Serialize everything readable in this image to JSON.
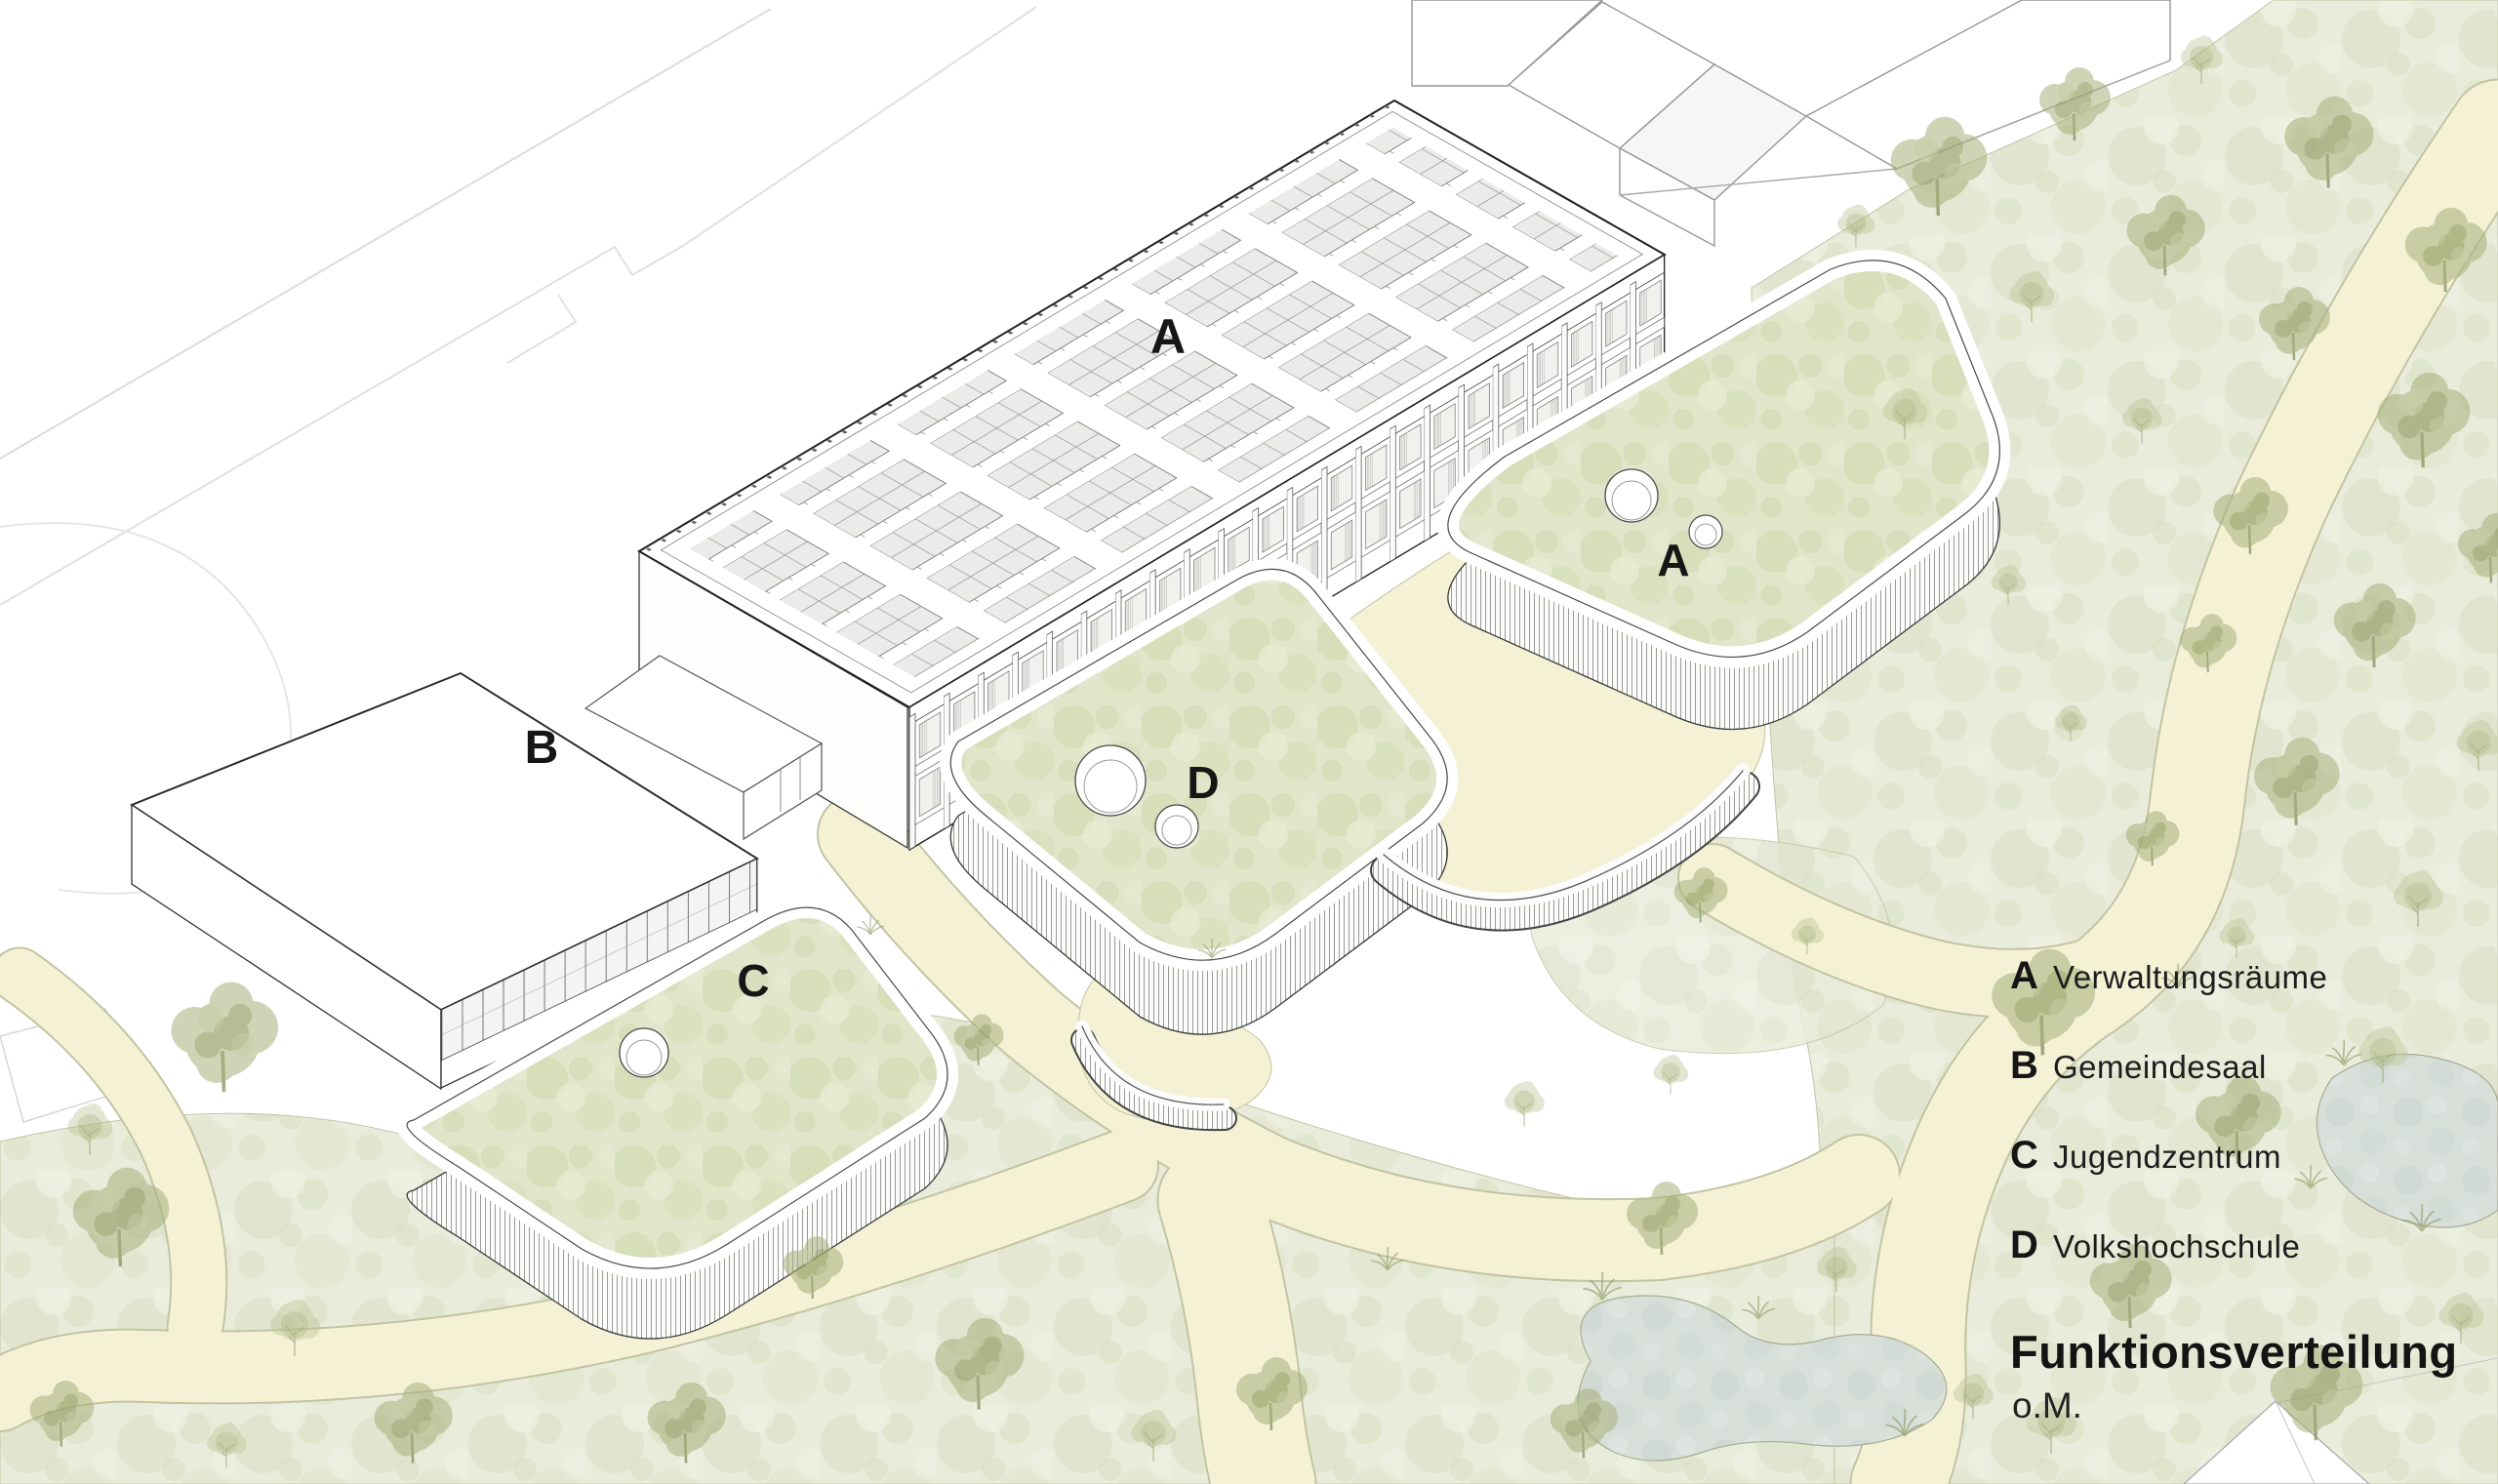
{
  "diagram": {
    "kind": "architectural axonometric site diagram",
    "building_labels": {
      "bar_roof": "A",
      "wing_a_roof": "A",
      "hall_b": "B",
      "wing_c_roof": "C",
      "wing_d_roof": "D"
    },
    "legend": {
      "items": [
        {
          "key": "A",
          "label": "Verwaltungsräume"
        },
        {
          "key": "B",
          "label": "Gemeindesaal"
        },
        {
          "key": "C",
          "label": "Jugendzentrum"
        },
        {
          "key": "D",
          "label": "Volkshochschule"
        }
      ],
      "title": "Funktionsverteilung",
      "scale_note": "o.M."
    },
    "colors": {
      "paper": "#ffffff",
      "lawn": "#e9ecdb",
      "path": "#f4f1d5",
      "pond": "#d8dfd9",
      "roof_green": "#e1e6ca",
      "tree_green": "#a7b17c",
      "ink": "#1b1b1b"
    }
  }
}
